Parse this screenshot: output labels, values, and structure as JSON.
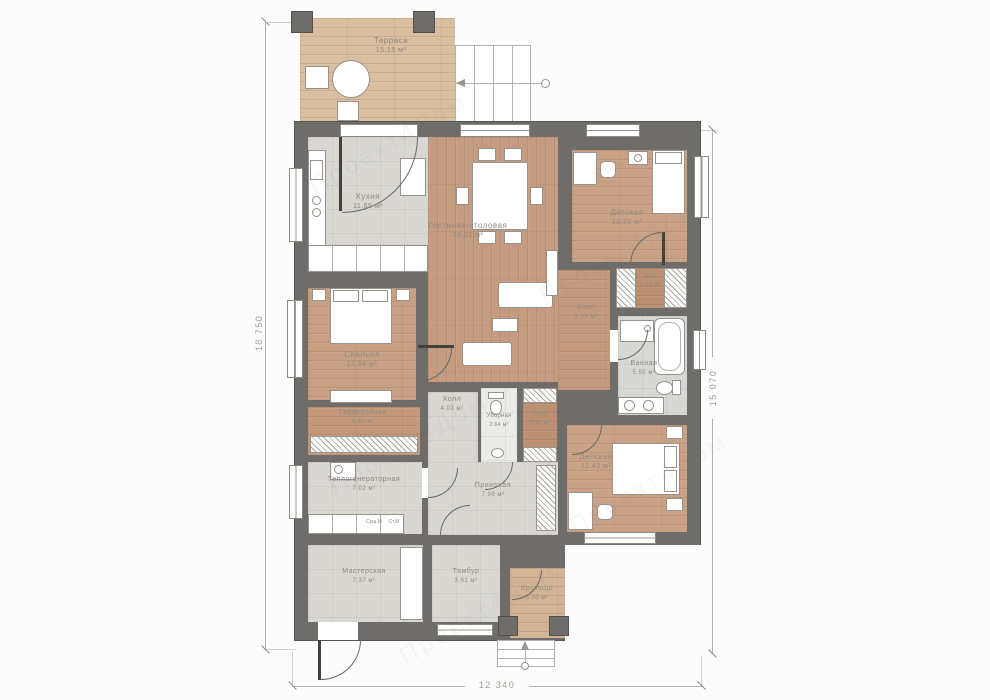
{
  "plan": {
    "dimensions": {
      "left": "18 750",
      "right": "15 070",
      "bottom": "12 340"
    },
    "rooms": {
      "terrace": {
        "name": "Терраса",
        "area": "15.15 м²"
      },
      "kitchen": {
        "name": "Кухня",
        "area": "11.65 м²"
      },
      "living": {
        "name": "Гостиная-столовая",
        "area": "29.02 м²"
      },
      "child1": {
        "name": "Детская",
        "area": "12.35 м²"
      },
      "ward244": {
        "name": "Гард.",
        "area": "2.44 м²"
      },
      "hall319": {
        "name": "Холл",
        "area": "3.19 м²"
      },
      "bath": {
        "name": "Ванная",
        "area": "5.92 м²"
      },
      "bedroom": {
        "name": "Спальня",
        "area": "12.84 м²"
      },
      "wardrobe": {
        "name": "Гардеробная",
        "area": "4.80 м²"
      },
      "hall403": {
        "name": "Холл",
        "area": "4.03 м²"
      },
      "wc": {
        "name": "Уборная",
        "area": "2.64 м²"
      },
      "ward255": {
        "name": "Гард.",
        "area": "2.55 м²"
      },
      "child2": {
        "name": "Детская",
        "area": "12.42 м²"
      },
      "boiler": {
        "name": "Теплогенераторная",
        "area": "7.02 м²"
      },
      "entry": {
        "name": "Прихожая",
        "area": "7.99 м²"
      },
      "workshop": {
        "name": "Мастерская",
        "area": "7.37 м²"
      },
      "tambour": {
        "name": "Тамбур",
        "area": "3.61 м²"
      },
      "porch": {
        "name": "Крыльцо",
        "area": "5.00 м²"
      }
    },
    "appliances": {
      "dryer": "Суш.М",
      "washer": "Ст.М"
    },
    "watermark": "Проект4Дом",
    "colors": {
      "wall": "#6f6d6a",
      "wood": "#c9a184",
      "tile": "#d8d7d2",
      "terrace_wood": "#d9bf9f"
    }
  }
}
